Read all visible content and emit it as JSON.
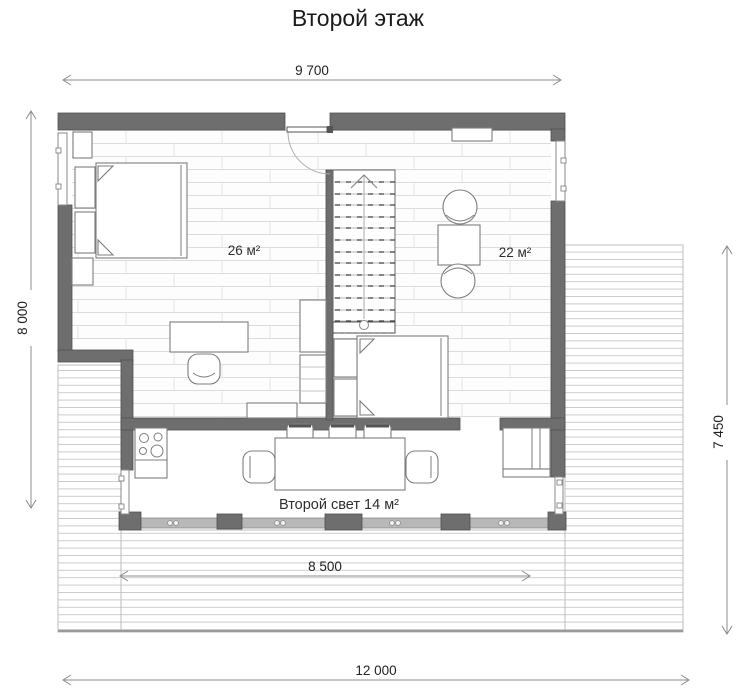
{
  "title": "Второй этаж",
  "dimensions": {
    "top_width": "9 700",
    "left_height": "8 000",
    "right_height": "7 450",
    "terrace_width": "8 500",
    "total_width": "12 000"
  },
  "rooms": {
    "bedroom_left_area": "26 м²",
    "hall_right_area": "22 м²",
    "double_height_label": "Второй свет 14 м²"
  },
  "colors": {
    "wall": "#6e6e6e",
    "wall_edge": "#4f4f4f",
    "floor_plank_line": "#dcdcdc",
    "deck_line": "#cccccc",
    "railing_band": "#b8b8b8",
    "dimension_line": "#8c8c8c",
    "text": "#1a1a1a"
  },
  "icons": {
    "staircase": "stairs-up-arrow-icon",
    "balcony_door": "door-swing-icon",
    "stove": "four-burner-stove-icon"
  }
}
